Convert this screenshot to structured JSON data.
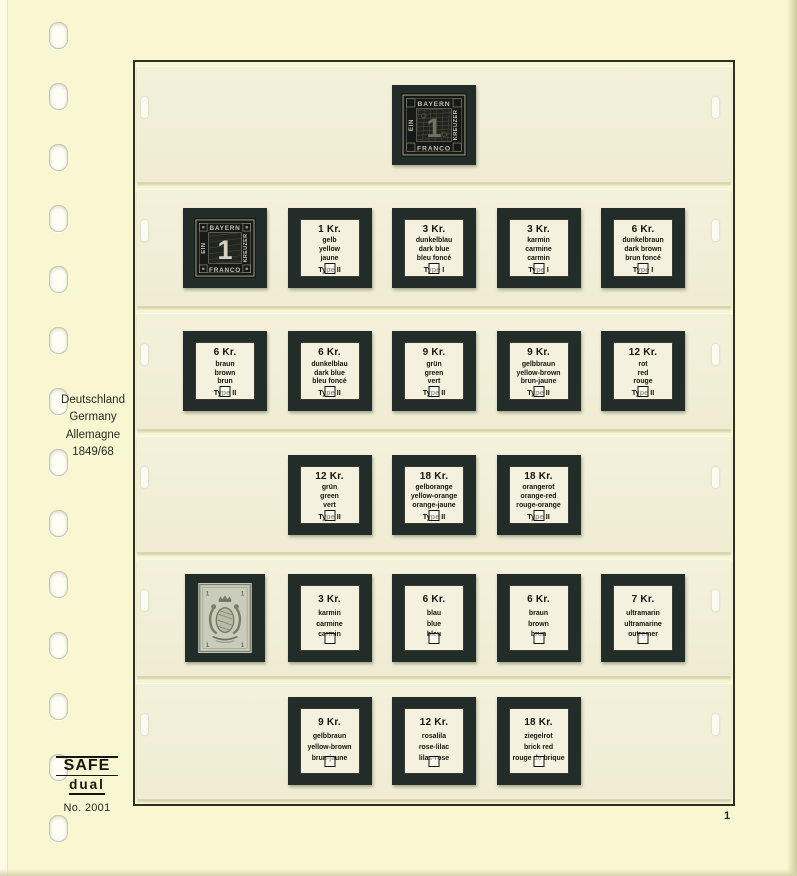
{
  "sidebar": {
    "country_lines": [
      "Deutschland",
      "Germany",
      "Allemagne"
    ],
    "period": "1849/68"
  },
  "brand": {
    "name": "SAFE",
    "sub": "dual",
    "number": "No. 2001"
  },
  "page_number": "1",
  "stamps": {
    "kreuzer_black": {
      "top_label": "BAYERN",
      "bottom_label": "FRANCO",
      "left_label": "EIN",
      "right_label": "KREUZER",
      "value": "1"
    },
    "arms": {
      "corner_value": "1"
    }
  },
  "strips": [
    {
      "tall": false,
      "cells": [
        null,
        null,
        {
          "kind": "stamp",
          "variant": "einser-ornate"
        },
        null,
        null
      ]
    },
    {
      "tall": false,
      "cells": [
        {
          "kind": "stamp",
          "variant": "einser"
        },
        {
          "kind": "label",
          "value": "1 Kr.",
          "colors": [
            "gelb",
            "yellow",
            "jaune"
          ],
          "type": "Type II"
        },
        {
          "kind": "label",
          "value": "3 Kr.",
          "colors": [
            "dunkelblau",
            "dark blue",
            "bleu foncé"
          ],
          "type": "Type I"
        },
        {
          "kind": "label",
          "value": "3 Kr.",
          "colors": [
            "karmin",
            "carmine",
            "carmin"
          ],
          "type": "Type I"
        },
        {
          "kind": "label",
          "value": "6 Kr.",
          "colors": [
            "dunkelbraun",
            "dark brown",
            "brun foncé"
          ],
          "type": "Type I"
        }
      ]
    },
    {
      "tall": false,
      "cells": [
        {
          "kind": "label",
          "value": "6 Kr.",
          "colors": [
            "braun",
            "brown",
            "brun"
          ],
          "type": "Type II"
        },
        {
          "kind": "label",
          "value": "6 Kr.",
          "colors": [
            "dunkelblau",
            "dark blue",
            "bleu foncé"
          ],
          "type": "Type II"
        },
        {
          "kind": "label",
          "value": "9 Kr.",
          "colors": [
            "grün",
            "green",
            "vert"
          ],
          "type": "Type II"
        },
        {
          "kind": "label",
          "value": "9 Kr.",
          "colors": [
            "gelbbraun",
            "yellow-brown",
            "brun-jaune"
          ],
          "type": "Type II"
        },
        {
          "kind": "label",
          "value": "12 Kr.",
          "colors": [
            "rot",
            "red",
            "rouge"
          ],
          "type": "Type II"
        }
      ]
    },
    {
      "tall": false,
      "cells": [
        null,
        {
          "kind": "label",
          "value": "12 Kr.",
          "colors": [
            "grün",
            "green",
            "vert"
          ],
          "type": "Type II"
        },
        {
          "kind": "label",
          "value": "18 Kr.",
          "colors": [
            "gelborange",
            "yellow-orange",
            "orange-jaune"
          ],
          "type": "Type II"
        },
        {
          "kind": "label",
          "value": "18 Kr.",
          "colors": [
            "orangerot",
            "orange-red",
            "rouge-orange"
          ],
          "type": "Type II"
        },
        null
      ]
    },
    {
      "tall": true,
      "cells": [
        {
          "kind": "stamp",
          "variant": "arms"
        },
        {
          "kind": "label",
          "value": "3 Kr.",
          "colors": [
            "karmin",
            "carmine",
            "carmin"
          ],
          "type": null
        },
        {
          "kind": "label",
          "value": "6 Kr.",
          "colors": [
            "blau",
            "blue",
            "bleu"
          ],
          "type": null
        },
        {
          "kind": "label",
          "value": "6 Kr.",
          "colors": [
            "braun",
            "brown",
            "brun"
          ],
          "type": null
        },
        {
          "kind": "label",
          "value": "7 Kr.",
          "colors": [
            "ultramarin",
            "ultramarine",
            "outremer"
          ],
          "type": null
        }
      ]
    },
    {
      "tall": true,
      "cells": [
        null,
        {
          "kind": "label",
          "value": "9 Kr.",
          "colors": [
            "gelbbraun",
            "yellow-brown",
            "brun-jaune"
          ],
          "type": null
        },
        {
          "kind": "label",
          "value": "12 Kr.",
          "colors": [
            "rosalila",
            "rose-lilac",
            "lilas-rose"
          ],
          "type": null
        },
        {
          "kind": "label",
          "value": "18 Kr.",
          "colors": [
            "ziegelrot",
            "brick red",
            "rouge de brique"
          ],
          "type": null
        },
        null
      ]
    }
  ]
}
